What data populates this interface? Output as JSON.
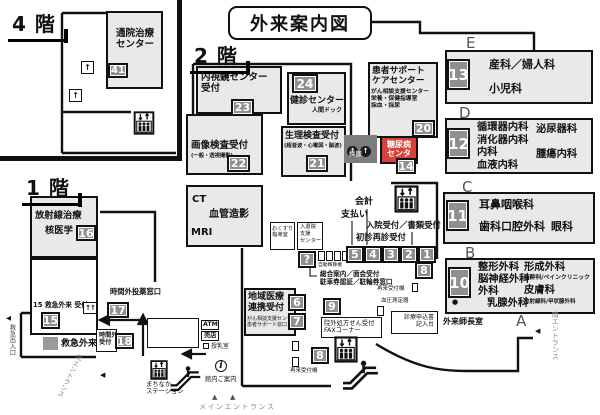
{
  "title": "外来案内図",
  "colors": {
    "room_fill": "#e9e9e9",
    "badge_fill": "#8f8f8f",
    "diabetes_red": "#d9403a"
  },
  "icons": {
    "up_arrow": "↑",
    "double_up_arrow": "↑↑",
    "info": "i",
    "bullet": "●",
    "tri_left": "◀",
    "tri_up": "▲"
  },
  "badges": {
    "n1": "1",
    "n2": "2",
    "n3": "3",
    "n4": "4",
    "n5": "5",
    "n6": "6",
    "n7": "7",
    "n8": "8",
    "n9": "9",
    "n10": "10",
    "n11": "11",
    "n12": "12",
    "n13": "13",
    "n14": "14",
    "n15": "15",
    "n16": "16",
    "n17": "17",
    "n18": "18",
    "n20": "20",
    "n21": "21",
    "n22": "22",
    "n23": "23",
    "n24": "24",
    "n41": "41",
    "question": "?"
  },
  "f4": {
    "label": "4 階",
    "outpatient_treatment_center": "通院治療\nセンター"
  },
  "f2": {
    "label": "2 階",
    "endoscopy_reception": "内視鏡センター\n受付",
    "checkup_center": "健診センター",
    "checkup_center_sub": "人間ドック",
    "physiology_reception": "生理検査受付",
    "physiology_sub": "(超音波・心電図・脳波)",
    "imaging_reception": "画像検査受付",
    "imaging_sub": "(一般・透視撮影)",
    "ct": "CT",
    "angiography": "血管造影",
    "mri": "MRI",
    "patient_support": "患者サポート\nケアセンター",
    "patient_support_sub": "がん相談支援センター\n栄養・保健指導室\n採血・採尿",
    "urine_sampling": "採尿",
    "diabetes_center": "糖尿病\nセンター",
    "cashier": "会計",
    "payment": "支払い",
    "admission_reception": "入院受付／書類受付",
    "first_return_reception": "初診再診受付",
    "auto_pay_machine": "自動精算機",
    "general_info": "総合案内／面会受付\n駐車券認証／駐輪券窓口",
    "medicine_guidance": "おくすり\n指導室",
    "admission_support": "入退院\n支援\nセンター",
    "regional_medical": "地域医療\n連携受付",
    "regional_medical_sub": "がん相談支援センター\n患者サポート窓口",
    "prescription_fax": "院外処方せん受付\nFAXコーナー",
    "return_machine_right": "再来受付機",
    "blood_pressure": "血圧測定器",
    "application_desk": "診療申込書\n記入台",
    "return_machine_bottom": "再来受付機",
    "head_nurse_room": "外来師長室",
    "south_entrance": "南エントランス",
    "sections": {
      "a": "A",
      "b": "B",
      "c": "C",
      "d": "D",
      "e": "E"
    },
    "dept_e": {
      "line1": "産科／婦人科",
      "line2": "小児科"
    },
    "dept_d": {
      "col1": "循環器内科\n消化器内科\n内科\n血液内科",
      "urology": "泌尿器科",
      "oncology": "腫瘍内科"
    },
    "dept_c": {
      "ent": "耳鼻咽喉科",
      "dental": "歯科口腔外科",
      "eye": "眼科"
    },
    "dept_b": {
      "col1": "整形外科\n脳神経外科\n外科",
      "breast": "乳腺外科",
      "plastic": "形成外科",
      "anesthesia": "麻酔科/ペインクリニック",
      "derma": "皮膚科",
      "small": "放射線科/甲状腺外科"
    }
  },
  "f1": {
    "label": "1 階",
    "radiation": "放射線治療",
    "nuclear": "核医学",
    "after_hours_pharmacy": "時間外投薬窓口",
    "er_reception_label": "15 救急外来 受付",
    "emergency": "救急外来",
    "after_hours_reception": "時間外\n受付",
    "emergency_exit": "救急出入口",
    "north_entrance": "北エントランス",
    "atm": "ATM",
    "shop": "売店",
    "nursing_room": "授乳室",
    "machinaka_station": "まちなか\nステーション",
    "info_guide": "館内ご案内",
    "main_entrance": "メインエントランス"
  }
}
